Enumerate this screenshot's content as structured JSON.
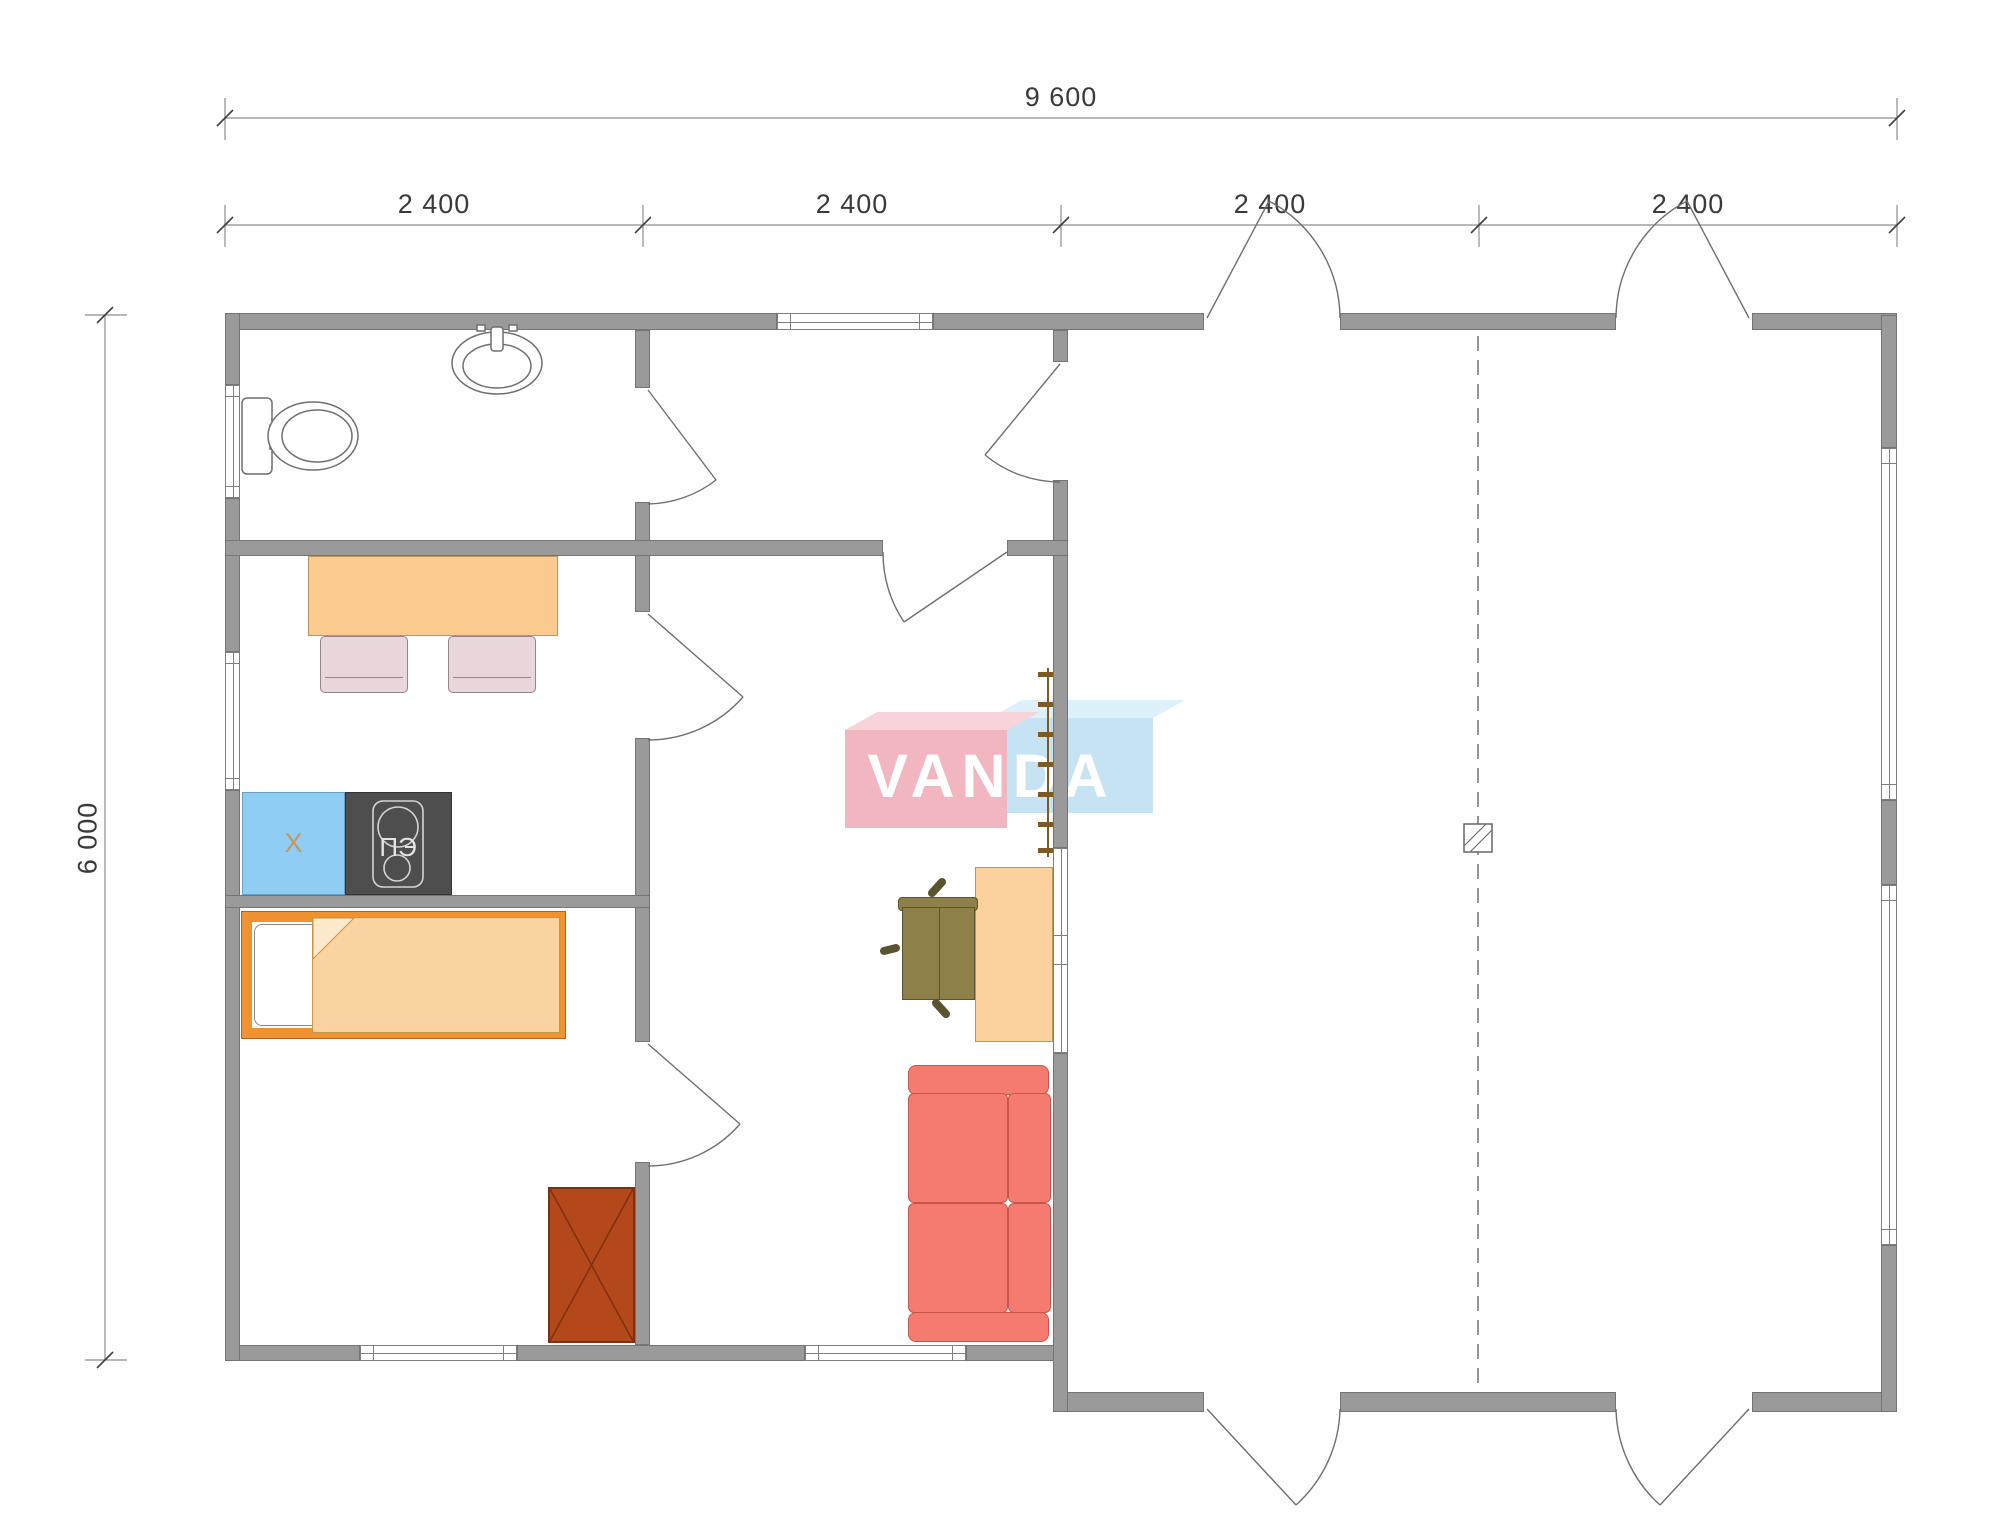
{
  "title": "floor-plan",
  "dimensions": {
    "overall_width": "9 600",
    "overall_height": "6 000",
    "segments": [
      "2 400",
      "2 400",
      "2 400",
      "2 400"
    ]
  },
  "logo": {
    "text": "VANDA"
  },
  "labels": {
    "fridge": "X",
    "stove": "ПЭ"
  },
  "colors": {
    "wall": "#9a9a9a",
    "wallEdge": "#747474",
    "dim": "#3a3a3a",
    "line": "#6f6f6f",
    "windowEdge": "#7f7f7f",
    "tableOrange": "#fbca8e",
    "tableEdge": "#c0935a",
    "deskOrange": "#fbd29e",
    "bedOrange": "#f0922f",
    "bedEdge": "#b36220",
    "blanket": "#fbd3a1",
    "blanketEdge": "#c79549",
    "chairPink": "#e9d6db",
    "chairPinkEdge": "#95838b",
    "fridgeBlue": "#8fcdf5",
    "fridgeEdge": "#6aa1c4",
    "fridgeText": "#c2995c",
    "stoveDark": "#4e4e4e",
    "stoveLight": "#d4d4d4",
    "stoveText": "#e3e3e3",
    "sofaRed": "#f57a70",
    "sofaEdge": "#c7554b",
    "olive": "#8d8149",
    "oliveEdge": "#5a5330",
    "rust": "#b5481b",
    "rustEdge": "#7e3110",
    "ladder": "#7c5a26",
    "logoPink": "#f2b6c1",
    "logoPinkTop": "#f8d3da",
    "logoBlue": "#c6e3f4",
    "logoBlueTop": "#ddf0fb"
  }
}
